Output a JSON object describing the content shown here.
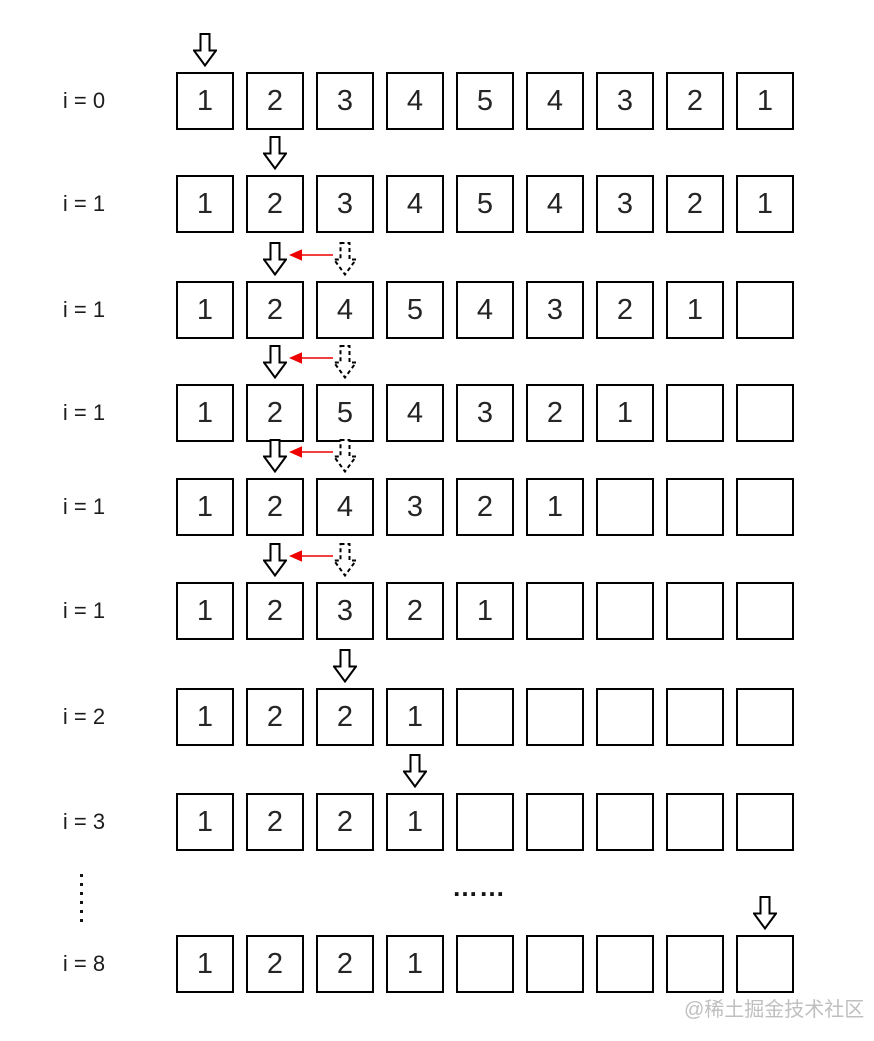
{
  "rows": [
    {
      "label": "i = 0",
      "values": [
        "1",
        "2",
        "3",
        "4",
        "5",
        "4",
        "3",
        "2",
        "1"
      ],
      "arrows": {
        "solid_index": 0
      }
    },
    {
      "label": "i = 1",
      "values": [
        "1",
        "2",
        "3",
        "4",
        "5",
        "4",
        "3",
        "2",
        "1"
      ],
      "arrows": {
        "solid_index": 1
      }
    },
    {
      "label": "i = 1",
      "values": [
        "1",
        "2",
        "4",
        "5",
        "4",
        "3",
        "2",
        "1",
        ""
      ],
      "arrows": {
        "solid_index": 1,
        "dashed_index": 2,
        "red_arrow": true
      }
    },
    {
      "label": "i = 1",
      "values": [
        "1",
        "2",
        "5",
        "4",
        "3",
        "2",
        "1",
        "",
        ""
      ],
      "arrows": {
        "solid_index": 1,
        "dashed_index": 2,
        "red_arrow": true
      }
    },
    {
      "label": "i = 1",
      "values": [
        "1",
        "2",
        "4",
        "3",
        "2",
        "1",
        "",
        "",
        ""
      ],
      "arrows": {
        "solid_index": 1,
        "dashed_index": 2,
        "red_arrow": true
      }
    },
    {
      "label": "i = 1",
      "values": [
        "1",
        "2",
        "3",
        "2",
        "1",
        "",
        "",
        "",
        ""
      ],
      "arrows": {
        "solid_index": 1,
        "dashed_index": 2,
        "red_arrow": true
      }
    },
    {
      "label": "i = 2",
      "values": [
        "1",
        "2",
        "2",
        "1",
        "",
        "",
        "",
        "",
        ""
      ],
      "arrows": {
        "solid_index": 2
      }
    },
    {
      "label": "i = 3",
      "values": [
        "1",
        "2",
        "2",
        "1",
        "",
        "",
        "",
        "",
        ""
      ],
      "arrows": {
        "solid_index": 3
      }
    },
    {
      "label": "i = 8",
      "values": [
        "1",
        "2",
        "2",
        "1",
        "",
        "",
        "",
        "",
        ""
      ],
      "arrows": {
        "solid_index": 8
      }
    }
  ],
  "ellipsis_horizontal": "……",
  "watermark": "@稀土掘金技术社区",
  "colors": {
    "box_border": "#000000",
    "arrow_outline": "#000000",
    "arrow_fill": "#ffffff",
    "arrow_red": "#ee0000",
    "watermark": "#bfbfbf",
    "text": "#252525"
  },
  "icons": {
    "down-arrow-solid-icon": "hollow block arrow pointing down (solid outline)",
    "down-arrow-dashed-icon": "hollow block arrow pointing down (dashed outline)",
    "red-left-arrow-icon": "thin red arrow pointing left",
    "ellipsis-dot": "small square dot"
  }
}
